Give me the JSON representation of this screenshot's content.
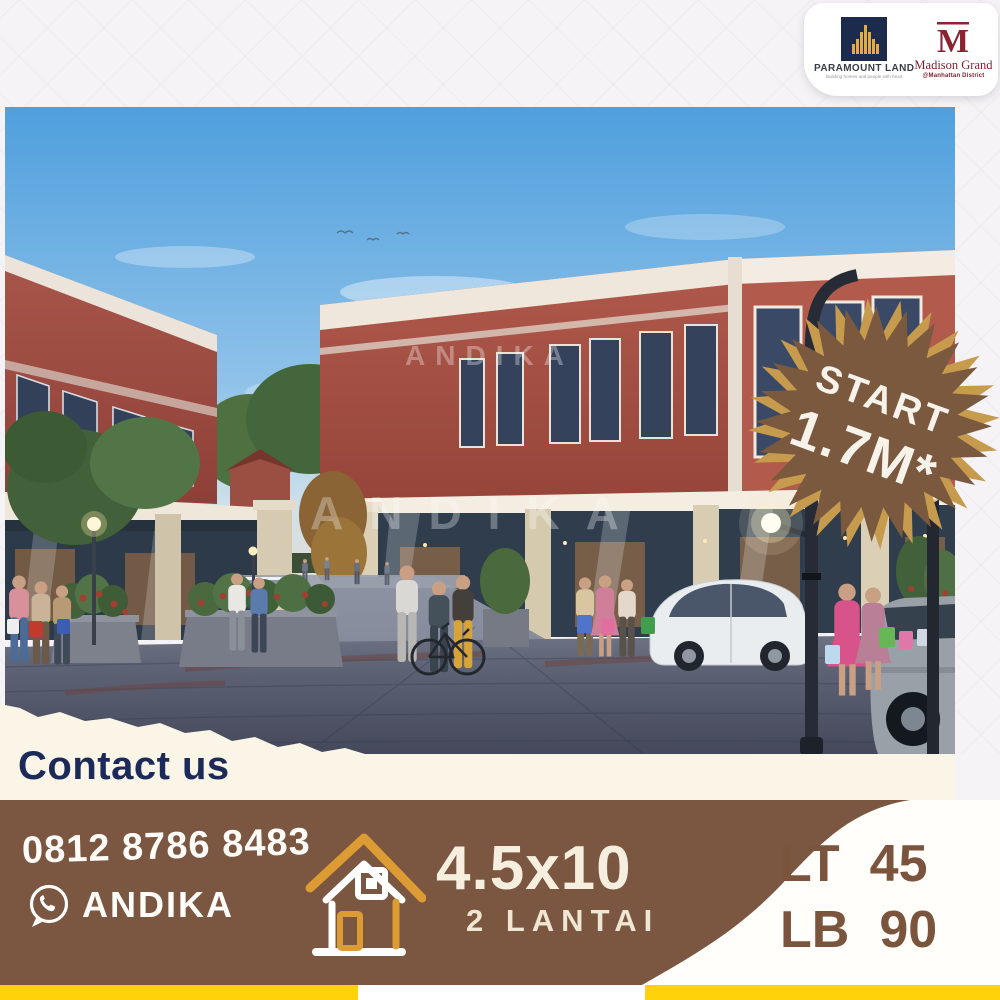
{
  "brand_bar": {
    "paramount": {
      "name": "PARAMOUNT LAND",
      "tagline": "Building homes and people with heart"
    },
    "madison": {
      "monogram": "M",
      "name": "Madison Grand",
      "district": "@Manhattan District"
    }
  },
  "photo": {
    "watermark": "ANDIKA",
    "signs": [
      "Salt'nCheese",
      "Harmonie"
    ]
  },
  "badge": {
    "line1": "START",
    "line2": "1.7M*"
  },
  "contact": {
    "heading": "Contact us",
    "phone": "0812 8786 8483",
    "name": "ANDIKA"
  },
  "specs": {
    "size": "4.5x10",
    "floors": "2 LANTAI",
    "lt_label": "LT",
    "lt_value": "45",
    "lb_label": "LB",
    "lb_value": "90"
  },
  "colors": {
    "bar_brown": "#7b5640",
    "badge_brown": "#7a593f",
    "badge_gold": "#c79b4e",
    "accent_yellow": "#ffd20a",
    "navy": "#1c2a5a",
    "cream": "#faf5e6",
    "maroon": "#8c2332",
    "paramount_navy": "#1c2b4c",
    "logo_gold": "#e0ac45"
  }
}
